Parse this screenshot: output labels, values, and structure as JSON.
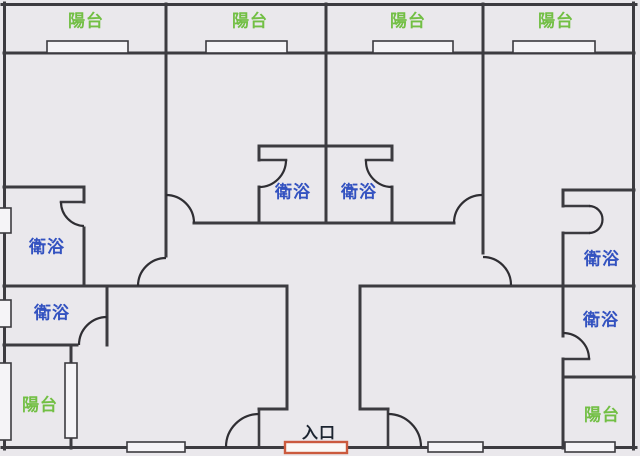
{
  "plan": {
    "type": "apartment-floor-plan",
    "colors": {
      "floor": "#eae8ec",
      "wall": "#3c3b40",
      "window_fill": "#f5f4f7",
      "balcony_label": "#72bf44",
      "bathroom_label": "#3352c0",
      "entrance_label": "#1c2430",
      "entrance_door_highlight": "#cb5a3e"
    },
    "labels": {
      "balconies": [
        {
          "text": "陽台"
        },
        {
          "text": "陽台"
        },
        {
          "text": "陽台"
        },
        {
          "text": "陽台"
        },
        {
          "text": "陽台"
        },
        {
          "text": "陽台"
        }
      ],
      "bathrooms": [
        {
          "text": "衛浴"
        },
        {
          "text": "衛浴"
        },
        {
          "text": "衛浴"
        },
        {
          "text": "衛浴"
        },
        {
          "text": "衛浴"
        },
        {
          "text": "衛浴"
        }
      ],
      "entrance": {
        "text": "入口"
      }
    },
    "counts": {
      "balconies": 6,
      "bathrooms": 6,
      "entrances": 1,
      "windows": 11
    }
  }
}
